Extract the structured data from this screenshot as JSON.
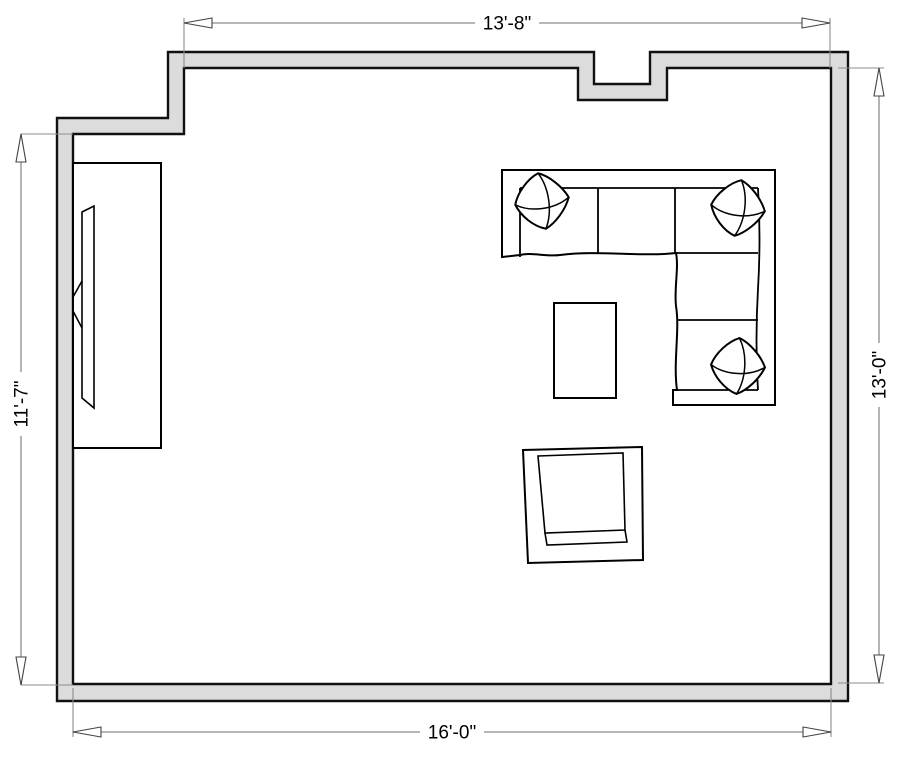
{
  "diagram_type": "floor-plan",
  "dimensions": {
    "top": {
      "label": "13'-8\""
    },
    "bottom": {
      "label": "16'-0\""
    },
    "left": {
      "label": "11'-7\""
    },
    "right": {
      "label": "13'-0\""
    }
  },
  "furniture": [
    {
      "name": "media-console"
    },
    {
      "name": "tv"
    },
    {
      "name": "sectional-sofa"
    },
    {
      "name": "throw-pillow-top-left"
    },
    {
      "name": "throw-pillow-top-right"
    },
    {
      "name": "throw-pillow-bottom-right"
    },
    {
      "name": "coffee-table"
    },
    {
      "name": "armchair"
    }
  ],
  "colors": {
    "background": "#ffffff",
    "wall_fill": "#dcdcdc",
    "wall_stroke": "#111111",
    "furniture_stroke": "#000000",
    "dimension_line": "#8c8c8c",
    "dimension_text": "#000000"
  }
}
